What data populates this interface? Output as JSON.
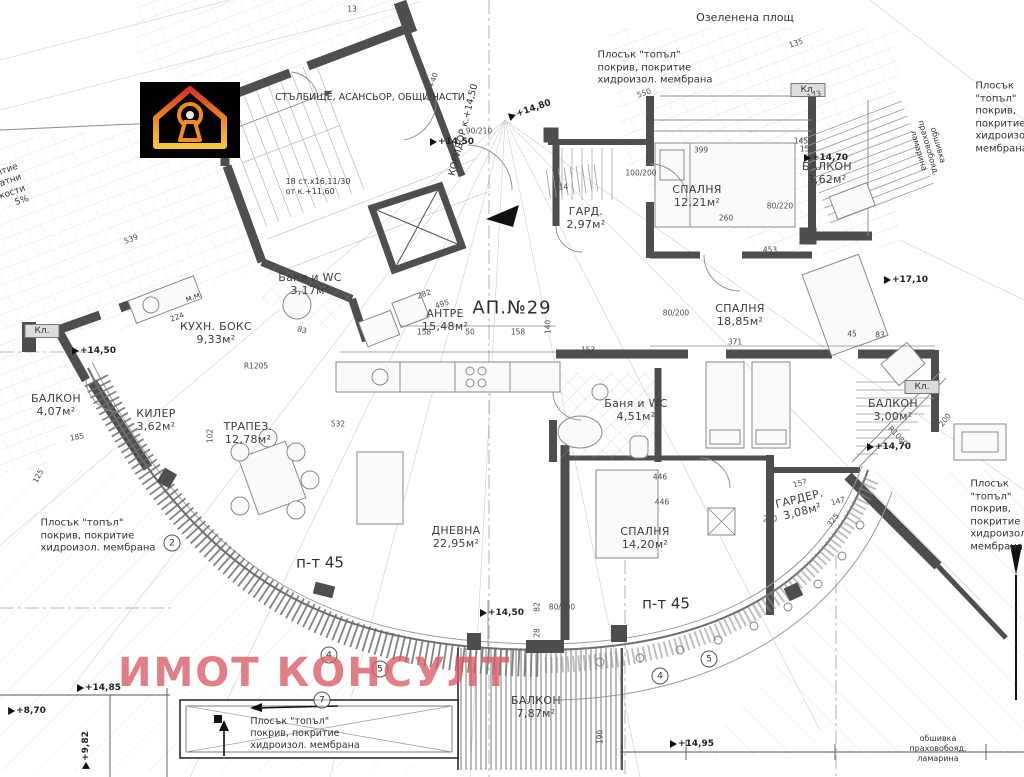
{
  "meta": {
    "apartment": "АП.№29",
    "watermark": "ИМОТ КОНСУЛТ",
    "logo": "house-keyhole-logo"
  },
  "colors": {
    "wall": "#4e4e4e",
    "thin_line": "#9a9a9a",
    "watermark": "#d85a64",
    "logo_bg": "#000000",
    "logo_gradient": [
      "#d63226",
      "#f08c1e",
      "#f6c544"
    ],
    "closet_fill": "#dddddd"
  },
  "rooms": [
    {
      "name": "СПАЛНЯ",
      "area": "12,21м²",
      "x": 697,
      "y": 197
    },
    {
      "name": "БАЛКОН",
      "area": "3,62м²",
      "x": 827,
      "y": 174
    },
    {
      "name": "ГАРД.",
      "area": "2,97м²",
      "x": 586,
      "y": 219
    },
    {
      "name": "Баня и WC",
      "area": "3,17м²",
      "x": 310,
      "y": 285
    },
    {
      "name": "КУХН. БОКС",
      "area": "9,33м²",
      "x": 216,
      "y": 334
    },
    {
      "name": "АНТРЕ",
      "area": "15,48м²",
      "x": 445,
      "y": 321
    },
    {
      "name": "СПАЛНЯ",
      "area": "18,85м²",
      "x": 740,
      "y": 316
    },
    {
      "name": "БАЛКОН",
      "area": "3,00м²",
      "x": 893,
      "y": 411
    },
    {
      "name": "БАЛКОН",
      "area": "4,07м²",
      "x": 56,
      "y": 406
    },
    {
      "name": "КИЛЕР",
      "area": "3,62м²",
      "x": 156,
      "y": 421
    },
    {
      "name": "ТРАПЕЗ.",
      "area": "12,78м²",
      "x": 248,
      "y": 434
    },
    {
      "name": "ДНЕВНА",
      "area": "22,95м²",
      "x": 456,
      "y": 538
    },
    {
      "name": "Баня и WC",
      "area": "4,51м²",
      "x": 636,
      "y": 411
    },
    {
      "name": "СПАЛНЯ",
      "area": "14,20м²",
      "x": 645,
      "y": 539
    },
    {
      "name": "ГАРДЕР.",
      "area": "3,08м²",
      "x": 801,
      "y": 506,
      "r": -14
    },
    {
      "name": "БАЛКОН",
      "area": "7,87м²",
      "x": 536,
      "y": 708
    }
  ],
  "notes": [
    {
      "text": "Озеленена площ",
      "x": 745,
      "y": 18,
      "fs": 11,
      "align": "center"
    },
    {
      "text": "Плосък \"топъл\"\nпокрив, покритие\nхидроизол. мембрана",
      "x": 655,
      "y": 68,
      "fs": 10
    },
    {
      "text": "Плосък \"топъл\"\nпокрив, покритие\nхидроизол. мембрана",
      "x": 1005,
      "y": 118,
      "fs": 10
    },
    {
      "text": "Плосък \"топъл\"\nпокрив, покритие\nхидроизол. мембрана",
      "x": 98,
      "y": 536,
      "fs": 10
    },
    {
      "text": "Плосък \"топъл\"\nпокрив, покритие\nхидроизол. мембрана",
      "x": 1000,
      "y": 516,
      "fs": 10
    },
    {
      "text": "Плосък \"топъл\"\nпокрив, покритие\nхидроизол. мембрана",
      "x": 305,
      "y": 734,
      "fs": 9.5
    },
    {
      "text": "СТЪЛБИЩЕ, АСАНСЬОР, ОБЩИ ЧАСТИ",
      "x": 370,
      "y": 98,
      "fs": 9.5,
      "align": "center"
    },
    {
      "text": "КОРИДОР к.+14,50",
      "x": 464,
      "y": 130,
      "fs": 9.5,
      "r": -76,
      "align": "center"
    },
    {
      "text": "18 ст.х16,11/30\nот к.+11,60",
      "x": 318,
      "y": 187,
      "fs": 8
    },
    {
      "text": "м.м.",
      "x": 194,
      "y": 297,
      "fs": 8,
      "r": -20
    },
    {
      "text": "п-т 45",
      "x": 320,
      "y": 563,
      "fs": 15,
      "cls": "pt45"
    },
    {
      "text": "п-т 45",
      "x": 666,
      "y": 604,
      "fs": 15,
      "cls": "pt45"
    },
    {
      "text": "обшивка праховобояд. ламарина",
      "x": 938,
      "y": 749,
      "fs": 8,
      "align": "center"
    },
    {
      "text": "обшивка праховобояд. ламарина",
      "x": 928,
      "y": 148,
      "fs": 8,
      "r": 74,
      "align": "center"
    },
    {
      "text": "покритие\nполикарбонатни\nплоскости\n5%",
      "x": -14,
      "y": 196,
      "fs": 9,
      "r": -19,
      "align": "right"
    }
  ],
  "closets": [
    {
      "label": "Кл.",
      "x": 808,
      "y": 90
    },
    {
      "label": "Кл.",
      "x": 922,
      "y": 387
    },
    {
      "label": "Кл.",
      "x": 42,
      "y": 331
    }
  ],
  "levels": [
    {
      "v": "+14,80",
      "x": 530,
      "y": 110,
      "r": -19
    },
    {
      "v": "+14,50",
      "x": 452,
      "y": 142
    },
    {
      "v": "+14,70",
      "x": 826,
      "y": 158
    },
    {
      "v": "+14,50",
      "x": 94,
      "y": 351
    },
    {
      "v": "+14,70",
      "x": 889,
      "y": 447
    },
    {
      "v": "+14,50",
      "x": 502,
      "y": 613
    },
    {
      "v": "+14,85",
      "x": 99,
      "y": 688
    },
    {
      "v": "+8,70",
      "x": 27,
      "y": 711
    },
    {
      "v": "+9,82",
      "x": 86,
      "y": 750,
      "r": -90
    },
    {
      "v": "+14,95",
      "x": 692,
      "y": 744
    },
    {
      "v": "+17,10",
      "x": 906,
      "y": 280
    }
  ],
  "dims": [
    {
      "v": "13",
      "x": 352,
      "y": 9
    },
    {
      "v": "539",
      "x": 131,
      "y": 239,
      "r": -21
    },
    {
      "v": "135",
      "x": 796,
      "y": 43,
      "r": -19
    },
    {
      "v": "550",
      "x": 644,
      "y": 93,
      "r": -19
    },
    {
      "v": "123",
      "x": 814,
      "y": 95,
      "r": -19
    },
    {
      "v": "140+40",
      "x": 431,
      "y": 87,
      "r": -72
    },
    {
      "v": "399",
      "x": 701,
      "y": 150
    },
    {
      "v": "145",
      "x": 801,
      "y": 141
    },
    {
      "v": "150",
      "x": 807,
      "y": 149
    },
    {
      "v": "114",
      "x": 561,
      "y": 187
    },
    {
      "v": "100/200",
      "x": 641,
      "y": 173
    },
    {
      "v": "90/210",
      "x": 479,
      "y": 131
    },
    {
      "v": "80/220",
      "x": 780,
      "y": 206
    },
    {
      "v": "260",
      "x": 726,
      "y": 218
    },
    {
      "v": "453",
      "x": 770,
      "y": 250
    },
    {
      "v": "282",
      "x": 424,
      "y": 294,
      "r": -19
    },
    {
      "v": "495",
      "x": 442,
      "y": 304,
      "r": -19
    },
    {
      "v": "158",
      "x": 424,
      "y": 332
    },
    {
      "v": "50",
      "x": 470,
      "y": 332
    },
    {
      "v": "158",
      "x": 518,
      "y": 332
    },
    {
      "v": "140",
      "x": 548,
      "y": 327,
      "r": -90
    },
    {
      "v": "153",
      "x": 588,
      "y": 350
    },
    {
      "v": "371",
      "x": 735,
      "y": 342
    },
    {
      "v": "45",
      "x": 852,
      "y": 334
    },
    {
      "v": "83",
      "x": 880,
      "y": 335
    },
    {
      "v": "80/200",
      "x": 676,
      "y": 313
    },
    {
      "v": "532",
      "x": 338,
      "y": 424
    },
    {
      "v": "102",
      "x": 210,
      "y": 436,
      "r": -90
    },
    {
      "v": "185",
      "x": 77,
      "y": 437,
      "r": -12
    },
    {
      "v": "125",
      "x": 38,
      "y": 476,
      "r": -62
    },
    {
      "v": "224",
      "x": 177,
      "y": 317,
      "r": -20
    },
    {
      "v": "83",
      "x": 302,
      "y": 330,
      "r": 18
    },
    {
      "v": "446",
      "x": 660,
      "y": 477
    },
    {
      "v": "446",
      "x": 662,
      "y": 502
    },
    {
      "v": "157",
      "x": 800,
      "y": 483,
      "r": -16
    },
    {
      "v": "147",
      "x": 838,
      "y": 501,
      "r": -16
    },
    {
      "v": "200",
      "x": 770,
      "y": 519
    },
    {
      "v": "325",
      "x": 833,
      "y": 520,
      "r": -52
    },
    {
      "v": "R1080",
      "x": 898,
      "y": 436,
      "r": 47
    },
    {
      "v": "R1205",
      "x": 256,
      "y": 366
    },
    {
      "v": "82",
      "x": 537,
      "y": 607,
      "r": -90
    },
    {
      "v": "28",
      "x": 537,
      "y": 633,
      "r": -90
    },
    {
      "v": "80/200",
      "x": 562,
      "y": 607
    },
    {
      "v": "200",
      "x": 945,
      "y": 420,
      "r": -52
    },
    {
      "v": "190",
      "x": 600,
      "y": 737,
      "r": -90
    }
  ],
  "grid_bubbles": [
    {
      "n": "2",
      "x": 172,
      "y": 543
    },
    {
      "n": "4",
      "x": 329,
      "y": 655
    },
    {
      "n": "5",
      "x": 380,
      "y": 669
    },
    {
      "n": "4",
      "x": 660,
      "y": 676
    },
    {
      "n": "5",
      "x": 709,
      "y": 659
    },
    {
      "n": "7",
      "x": 322,
      "y": 700
    }
  ]
}
